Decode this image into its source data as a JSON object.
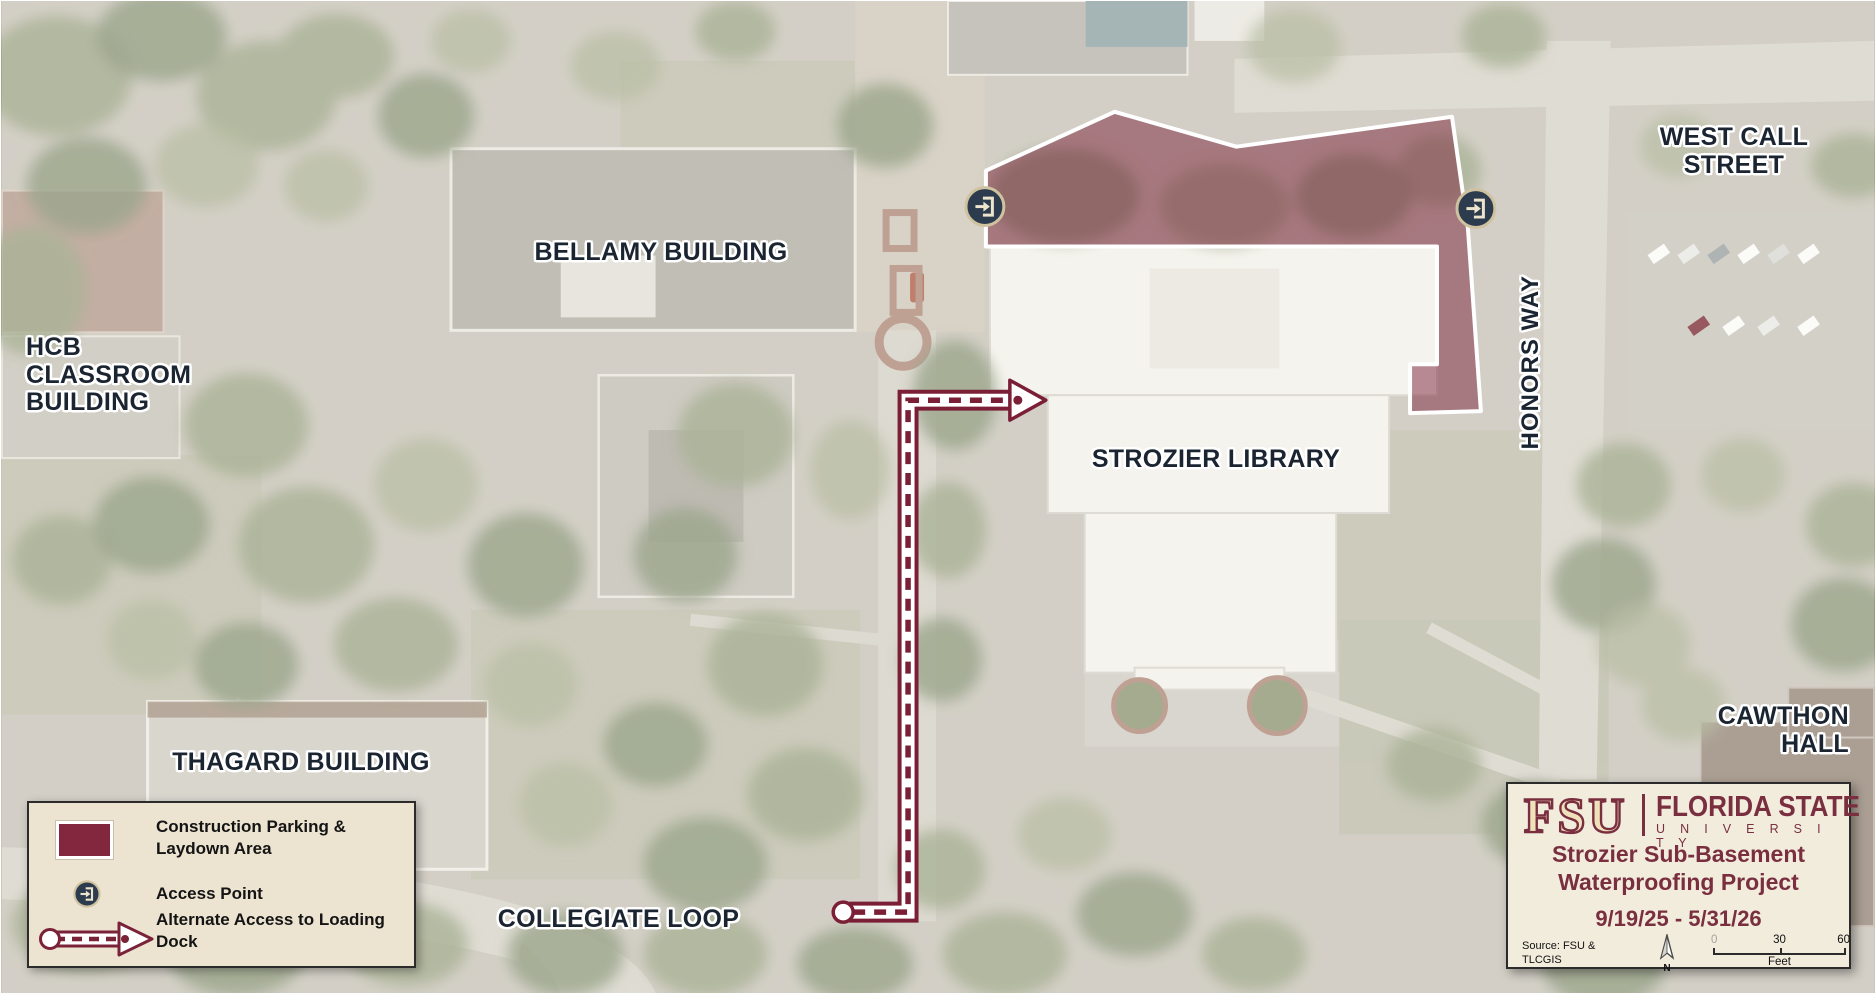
{
  "map": {
    "labels": {
      "bellamy": "BELLAMY BUILDING",
      "hcb": "HCB CLASSROOM BUILDING",
      "thagard": "THAGARD BUILDING",
      "strozier": "STROZIER LIBRARY",
      "west_call": "WEST CALL STREET",
      "honors_way": "HONORS WAY",
      "cawthon": "CAWTHON HALL",
      "collegiate": "COLLEGIATE LOOP"
    }
  },
  "legend": {
    "items": [
      {
        "icon": "construction-area-swatch",
        "label": "Construction Parking & Laydown Area"
      },
      {
        "icon": "access-point-icon",
        "label": "Access Point"
      },
      {
        "icon": "alternate-access-arrow",
        "label": "Alternate Access to Loading Dock"
      }
    ]
  },
  "infobox": {
    "logo": "FSU",
    "brand_line1": "FLORIDA STATE",
    "brand_line2": "U N I V E R S I T Y",
    "title_line1": "Strozier Sub-Basement",
    "title_line2": "Waterproofing Project",
    "date_range": "9/19/25 - 5/31/26",
    "source_line1": "Source: FSU &",
    "source_line2": "TLCGIS",
    "north": "N",
    "scalebar": {
      "start": "0",
      "mid": "30",
      "end": "60",
      "unit": "Feet"
    }
  },
  "colors": {
    "garnet": "#782F40",
    "construction_area_fill": "#7A2238",
    "route_maroon": "#7A1F35",
    "access_icon_bg": "#2C3B4D",
    "access_icon_ring": "#CFC2A0",
    "legend_bg": "#ECE3D1",
    "infobox_bg": "#F2ECDD",
    "label_text": "#1B2531"
  }
}
